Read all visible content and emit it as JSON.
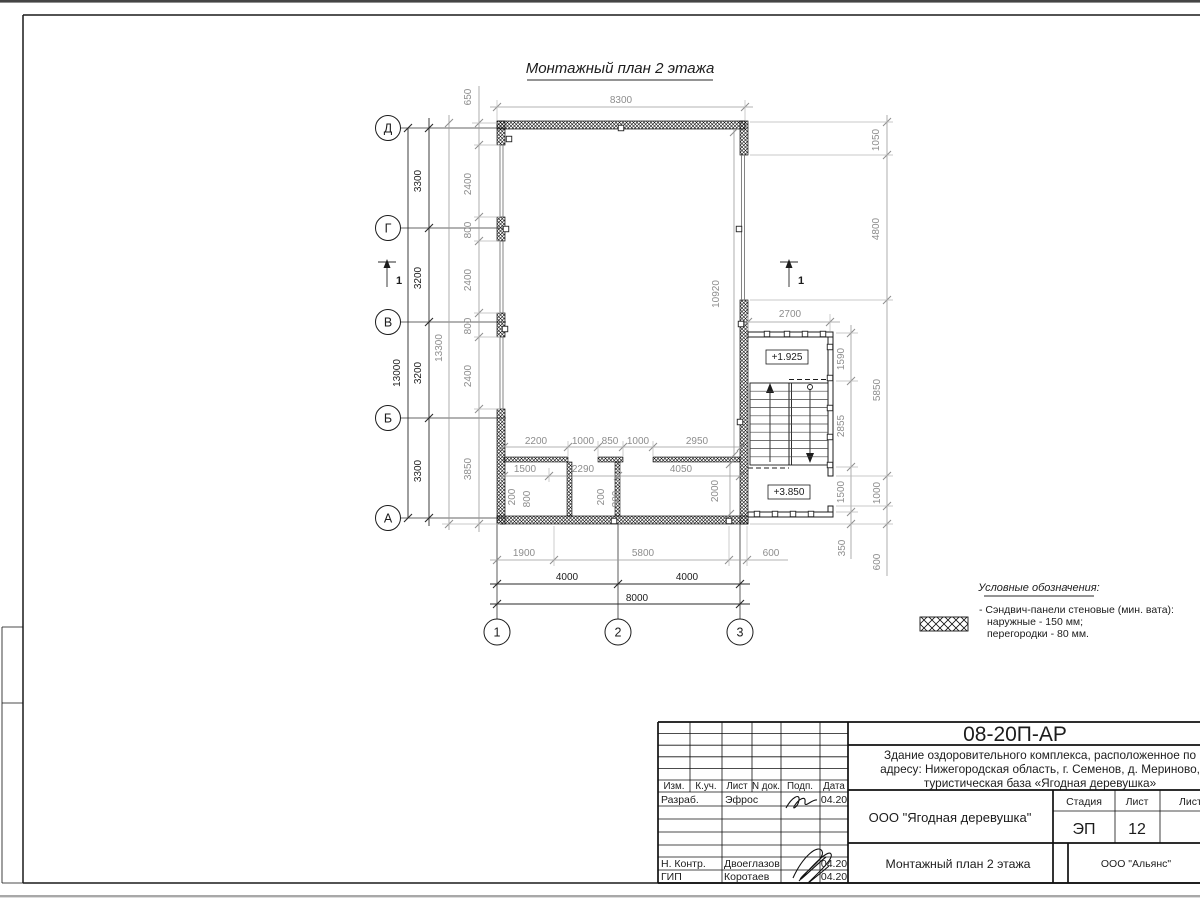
{
  "plan": {
    "title": "Монтажный план 2 этажа",
    "axes": {
      "rows": [
        {
          "label": "Д",
          "y": 128
        },
        {
          "label": "Г",
          "y": 228
        },
        {
          "label": "В",
          "y": 322
        },
        {
          "label": "Б",
          "y": 418
        },
        {
          "label": "А",
          "y": 518
        }
      ],
      "cols": [
        {
          "label": "1",
          "x": 497
        },
        {
          "label": "2",
          "x": 618
        },
        {
          "label": "3",
          "x": 740
        }
      ]
    },
    "dim_labels": [
      {
        "t": "13000",
        "x": 400,
        "y": 373,
        "r": 1,
        "c": "k"
      },
      {
        "t": "3300",
        "x": 421,
        "y": 181,
        "r": 1,
        "c": "k"
      },
      {
        "t": "3200",
        "x": 421,
        "y": 278,
        "r": 1,
        "c": "k"
      },
      {
        "t": "3200",
        "x": 421,
        "y": 373,
        "r": 1,
        "c": "k"
      },
      {
        "t": "3300",
        "x": 421,
        "y": 471,
        "r": 1,
        "c": "k"
      },
      {
        "t": "13300",
        "x": 442,
        "y": 348,
        "r": 1,
        "c": "g"
      },
      {
        "t": "650",
        "x": 471,
        "y": 97,
        "r": 1,
        "c": "g"
      },
      {
        "t": "2400",
        "x": 471,
        "y": 184,
        "r": 1,
        "c": "g"
      },
      {
        "t": "800",
        "x": 471,
        "y": 230,
        "r": 1,
        "c": "g"
      },
      {
        "t": "2400",
        "x": 471,
        "y": 280,
        "r": 1,
        "c": "g"
      },
      {
        "t": "800",
        "x": 471,
        "y": 326,
        "r": 1,
        "c": "g"
      },
      {
        "t": "2400",
        "x": 471,
        "y": 376,
        "r": 1,
        "c": "g"
      },
      {
        "t": "3850",
        "x": 471,
        "y": 469,
        "r": 1,
        "c": "g"
      },
      {
        "t": "8300",
        "x": 621,
        "y": 103,
        "c": "g"
      },
      {
        "t": "1900",
        "x": 524,
        "y": 556,
        "c": "g"
      },
      {
        "t": "5800",
        "x": 643,
        "y": 556,
        "c": "g"
      },
      {
        "t": "600",
        "x": 771,
        "y": 556,
        "c": "g"
      },
      {
        "t": "4000",
        "x": 567,
        "y": 580,
        "c": "k"
      },
      {
        "t": "4000",
        "x": 687,
        "y": 580,
        "c": "k"
      },
      {
        "t": "8000",
        "x": 637,
        "y": 601,
        "c": "k"
      },
      {
        "t": "2700",
        "x": 790,
        "y": 317,
        "c": "g"
      },
      {
        "t": "1050",
        "x": 879,
        "y": 140,
        "r": 1,
        "c": "g"
      },
      {
        "t": "4800",
        "x": 879,
        "y": 229,
        "r": 1,
        "c": "g"
      },
      {
        "t": "5850",
        "x": 880,
        "y": 390,
        "r": 1,
        "c": "g"
      },
      {
        "t": "1000",
        "x": 880,
        "y": 493,
        "r": 1,
        "c": "g"
      },
      {
        "t": "600",
        "x": 880,
        "y": 562,
        "r": 1,
        "c": "g"
      },
      {
        "t": "1590",
        "x": 844,
        "y": 359,
        "r": 1,
        "c": "g"
      },
      {
        "t": "2855",
        "x": 844,
        "y": 426,
        "r": 1,
        "c": "g"
      },
      {
        "t": "1500",
        "x": 844,
        "y": 492,
        "r": 1,
        "c": "g"
      },
      {
        "t": "350",
        "x": 845,
        "y": 548,
        "r": 1,
        "c": "g"
      },
      {
        "t": "10920",
        "x": 719,
        "y": 294,
        "r": 1,
        "c": "g"
      },
      {
        "t": "2000",
        "x": 718,
        "y": 491,
        "r": 1,
        "c": "g"
      },
      {
        "t": "2200",
        "x": 536,
        "y": 444,
        "c": "g"
      },
      {
        "t": "1000",
        "x": 583,
        "y": 444,
        "c": "g"
      },
      {
        "t": "850",
        "x": 610,
        "y": 444,
        "c": "g"
      },
      {
        "t": "1000",
        "x": 638,
        "y": 444,
        "c": "g"
      },
      {
        "t": "2950",
        "x": 697,
        "y": 444,
        "c": "g"
      },
      {
        "t": "1500",
        "x": 525,
        "y": 472,
        "c": "g"
      },
      {
        "t": "2290",
        "x": 583,
        "y": 472,
        "c": "g"
      },
      {
        "t": "4050",
        "x": 681,
        "y": 472,
        "c": "g"
      },
      {
        "t": "200",
        "x": 515,
        "y": 497,
        "r": 1,
        "c": "g"
      },
      {
        "t": "800",
        "x": 530,
        "y": 499,
        "r": 1,
        "c": "g"
      },
      {
        "t": "200",
        "x": 604,
        "y": 497,
        "r": 1,
        "c": "g"
      },
      {
        "t": "800",
        "x": 619,
        "y": 499,
        "r": 1,
        "c": "g"
      }
    ],
    "elevations": [
      {
        "t": "+1.925"
      },
      {
        "t": "+3.850"
      }
    ],
    "section_labels": [
      "1",
      "1"
    ],
    "legend": {
      "title": "Условные обозначения:",
      "items": [
        "- Сэндвич-панели стеновые (мин. вата):",
        "наружные - 150 мм;",
        "перегородки - 80 мм."
      ]
    }
  },
  "titleblock": {
    "code": "08-20П-АР",
    "description": [
      "Здание оздоровительного комплекса, расположенное по",
      "адресу: Нижегородская область, г. Семенов, д. Мериново,",
      "туристическая база «Ягодная деревушка»"
    ],
    "org": "ООО \"Ягодная деревушка\"",
    "drawing_name": "Монтажный план 2 этажа",
    "company": "ООО \"Альянс\"",
    "header_cols": [
      "Изм.",
      "К.уч.",
      "Лист",
      "N док.",
      "Подп.",
      "Дата"
    ],
    "stage_label": "Стадия",
    "sheet_label": "Лист",
    "sheets_label": "Листов",
    "stage": "ЭП",
    "sheet_no": "12",
    "rows": [
      {
        "role": "Разраб.",
        "name": "Эфрос",
        "date": "04.20"
      },
      {
        "role": "Н. Контр.",
        "name": "Двоеглазов",
        "date": "04.20"
      },
      {
        "role": "ГИП",
        "name": "Коротаев",
        "date": "04.20"
      }
    ]
  }
}
